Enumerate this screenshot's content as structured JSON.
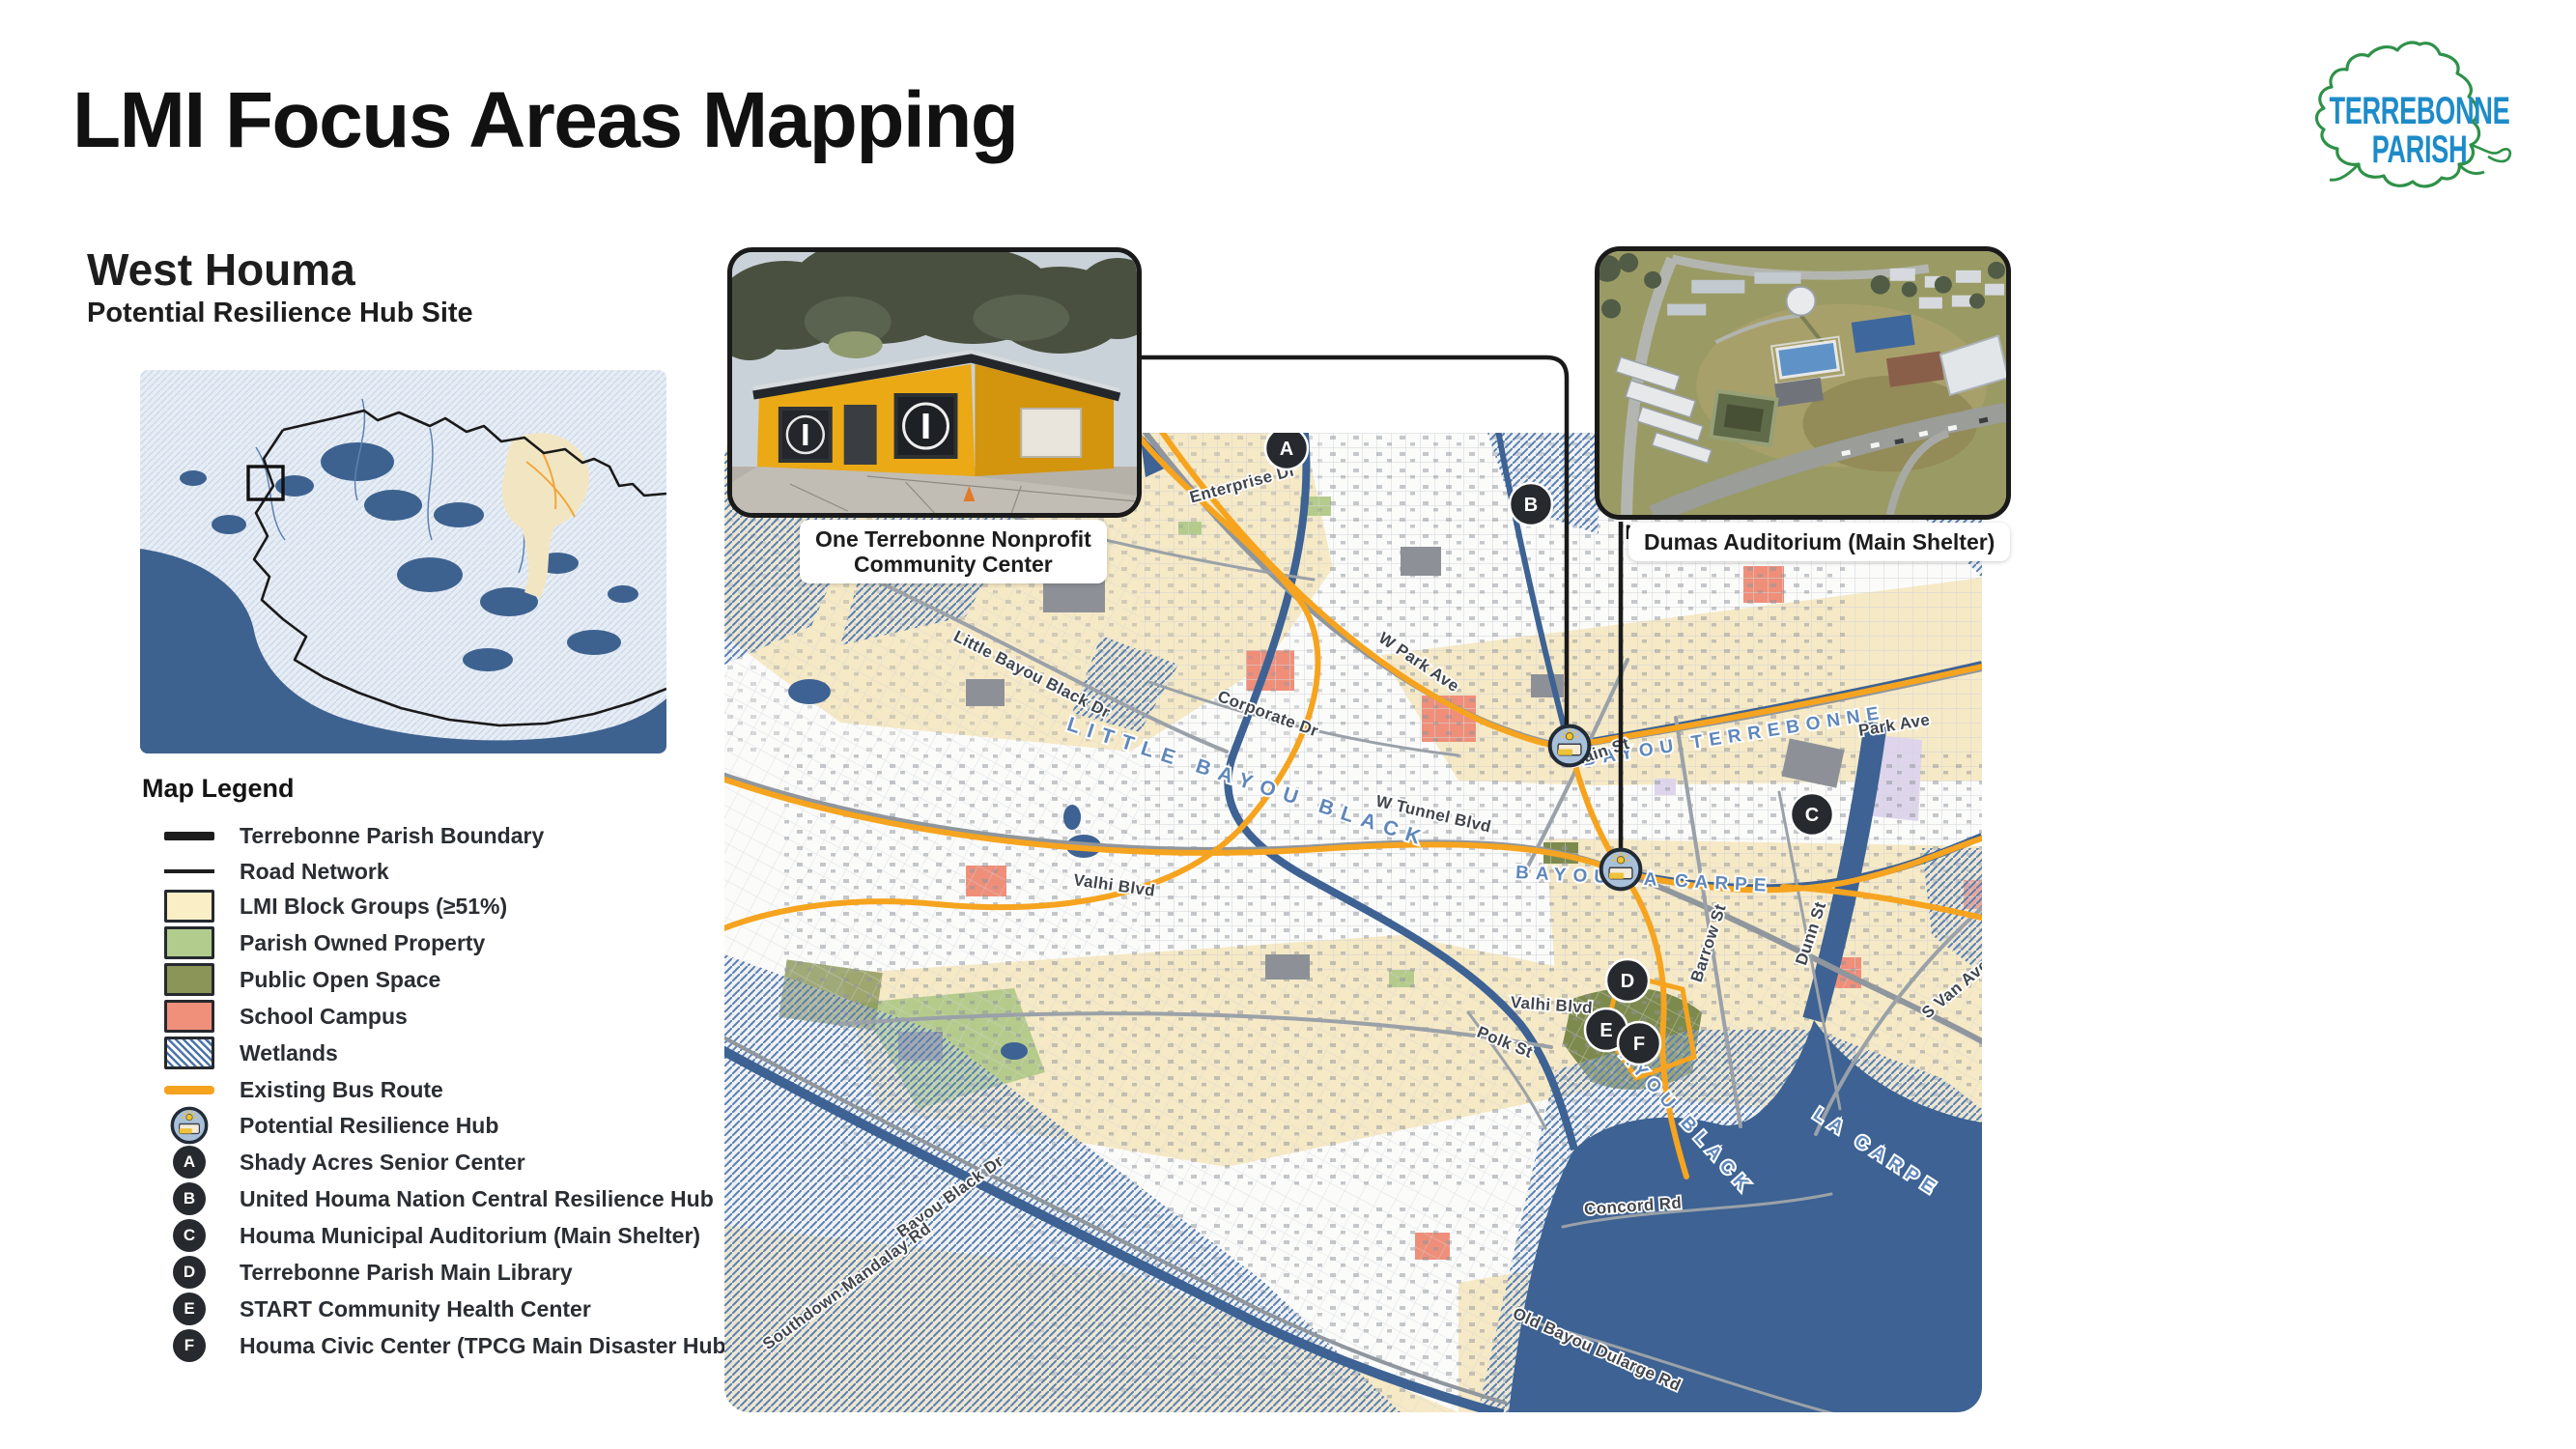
{
  "page": {
    "title": "LMI Focus Areas Mapping"
  },
  "logo": {
    "line1": "TERREBONNE",
    "line2": "PARISH"
  },
  "section": {
    "title": "West Houma",
    "subtitle": "Potential Resilience Hub Site"
  },
  "legend": {
    "heading": "Map Legend",
    "items": [
      {
        "label": "Terrebonne Parish Boundary"
      },
      {
        "label": "Road Network"
      },
      {
        "label": "LMI Block Groups (≥51%)"
      },
      {
        "label": "Parish Owned Property"
      },
      {
        "label": "Public Open Space"
      },
      {
        "label": "School Campus"
      },
      {
        "label": "Wetlands"
      },
      {
        "label": "Existing Bus Route"
      },
      {
        "label": "Potential Resilience Hub"
      },
      {
        "badge": "A",
        "label": "Shady Acres Senior Center"
      },
      {
        "badge": "B",
        "label": "United Houma Nation Central Resilience Hub"
      },
      {
        "badge": "C",
        "label": "Houma Municipal Auditorium (Main Shelter)"
      },
      {
        "badge": "D",
        "label": "Terrebonne Parish Main Library"
      },
      {
        "badge": "E",
        "label": "START Community Health Center"
      },
      {
        "badge": "F",
        "label": "Houma Civic Center (TPCG Main Disaster Hub)"
      }
    ]
  },
  "insets": {
    "community_center": {
      "line1": "One Terrebonne Nonprofit",
      "line2": "Community Center"
    },
    "auditorium": {
      "label": "Dumas Auditorium (Main Shelter)"
    }
  },
  "map": {
    "north": "N",
    "markers": [
      {
        "letter": "A"
      },
      {
        "letter": "B"
      },
      {
        "letter": "C"
      },
      {
        "letter": "D"
      },
      {
        "letter": "E"
      },
      {
        "letter": "F"
      }
    ],
    "road_labels": [
      "Enterprise Dr",
      "W Park Ave",
      "Corporate Dr",
      "Little Bayou Black Dr",
      "W Tunnel Blvd",
      "Main St",
      "Park Ave",
      "Barrow St",
      "Dunn St",
      "Valhi Blvd",
      "Valhi Blvd",
      "Polk St",
      "S Van Ave",
      "Bayou Black Dr",
      "Southdown Mandalay Rd",
      "Concord Rd",
      "Old Bayou Dularge Rd"
    ],
    "bayou_labels": [
      "LITTLE BAYOU BLACK",
      "BAYOU TERREBONNE",
      "BAYOU LA CARPE",
      "BAYOU BLACK",
      "LA CARPE"
    ]
  },
  "colors": {
    "lmi_block_group": "#faeec7",
    "parish_property": "#b2cc8e",
    "open_space": "#8a9557",
    "school_campus": "#f0907a",
    "bus_route": "#f5a21d",
    "water": "#3d6293",
    "wetland_stripe": "#4d74a8",
    "logo_blue": "#1e8bc9",
    "logo_green": "#2e9148"
  }
}
